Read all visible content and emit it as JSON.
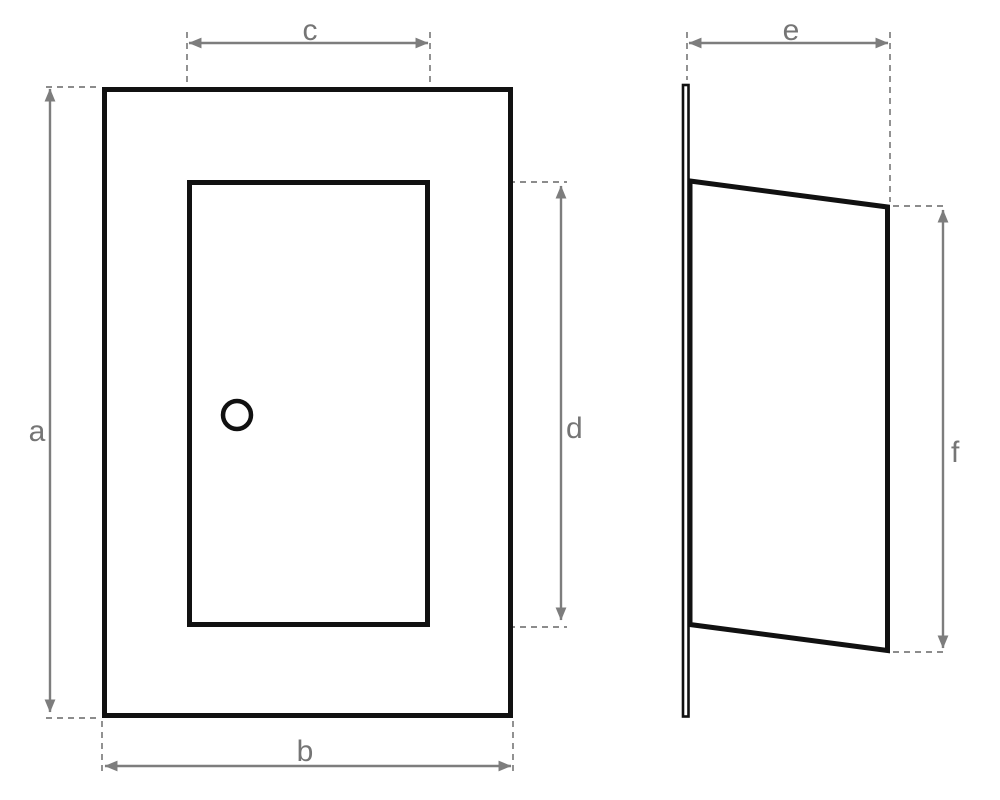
{
  "drawing": {
    "kind": "dimensioned-technical-drawing",
    "views": {
      "front_view": {
        "parts": [
          "outer-panel",
          "inner-door",
          "knob-hole"
        ],
        "dimension_labels": {
          "a": "a",
          "b": "b",
          "c": "c",
          "d": "d"
        }
      },
      "side_view": {
        "parts": [
          "flange-plate",
          "angled-panel"
        ],
        "dimension_labels": {
          "e": "e",
          "f": "f"
        }
      }
    },
    "colors": {
      "background": "#ffffff",
      "part_outline": "#111111",
      "dimension_line": "#7d7d7d",
      "extension_line": "#8c8c8c",
      "label_text": "#757575"
    }
  }
}
